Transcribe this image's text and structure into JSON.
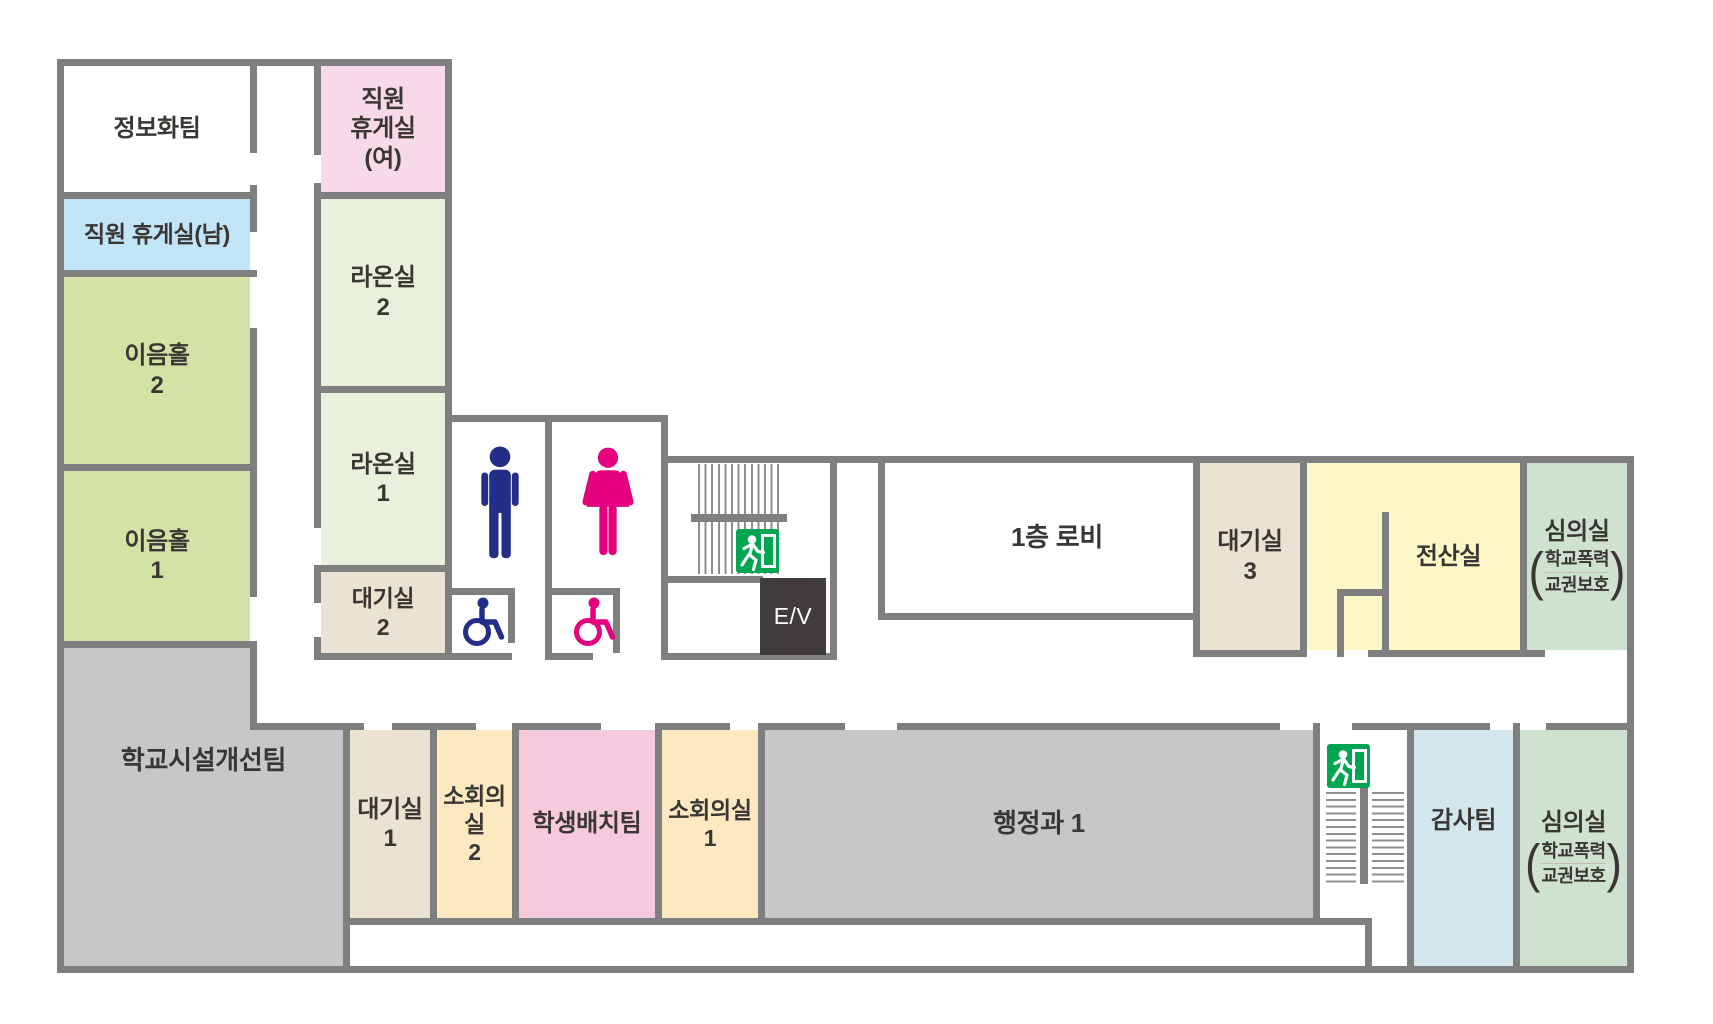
{
  "palette": {
    "wall": "#7f7f7f",
    "stair_line": "#8f8f8f",
    "exit_green": "#00a551",
    "elevator_bg": "#403c3b",
    "men_icon": "#232e88",
    "women_icon": "#e5007e",
    "label_text": "#3a3633"
  },
  "fixtures": {
    "elevator_label": "E/V"
  },
  "icons": {
    "men_restroom": "men-pictogram",
    "women_restroom": "women-pictogram",
    "accessible_restroom": "wheelchair-pictogram",
    "emergency_exit": "running-man-exit-sign",
    "stairs": "stair-treads"
  },
  "rooms": [
    {
      "label": "정보화팀",
      "color": "#ffffff"
    },
    {
      "label": "직원\n휴게실\n(여)",
      "color": "#f8d9e7"
    },
    {
      "label": "직원 휴게실(남)",
      "color": "#c1e4f6"
    },
    {
      "label": "이음홀\n2",
      "color": "#d3e3a6"
    },
    {
      "label": "이음홀\n1",
      "color": "#d3e3a6"
    },
    {
      "label": "라온실\n2",
      "color": "#e9f0dc"
    },
    {
      "label": "라온실\n1",
      "color": "#e9f0dc"
    },
    {
      "label": "대기실\n2",
      "color": "#eae2d3"
    },
    {
      "label": "1층 로비",
      "color": "#ffffff"
    },
    {
      "label": "대기실\n3",
      "color": "#eae2d3"
    },
    {
      "label": "전산실",
      "color": "#fdf7c8"
    },
    {
      "label": "심의실",
      "sub1": "학교폭력",
      "sub2": "교권보호",
      "color": "#cfe2d2"
    },
    {
      "label": "학교시설개선팀",
      "color": "#c7c7c9"
    },
    {
      "label": "대기실\n1",
      "color": "#eae2d3"
    },
    {
      "label": "소회의실\n2",
      "color": "#fce9c1"
    },
    {
      "label": "학생배치팀",
      "color": "#f6c9dc"
    },
    {
      "label": "소회의실\n1",
      "color": "#fce9c1"
    },
    {
      "label": "행정과 1",
      "color": "#c7c7c9"
    },
    {
      "label": "감사팀",
      "color": "#d2e7ec"
    },
    {
      "label": "심의실",
      "sub1": "학교폭력",
      "sub2": "교권보호",
      "color": "#cfe2d2"
    },
    {
      "label": "",
      "color": "#ffffff"
    },
    {
      "label": "",
      "color": "#ffffff"
    }
  ]
}
